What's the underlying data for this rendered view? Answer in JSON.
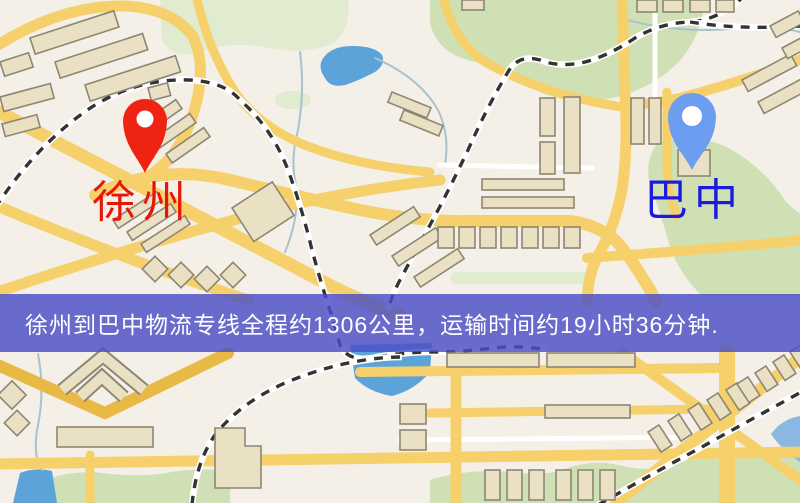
{
  "banner": {
    "text": "徐州到巴中物流专线全程约1306公里，运输时间约19小时36分钟.",
    "background_color": "rgba(74,78,198,0.82)",
    "text_color": "#ffffff",
    "route": {
      "origin": "徐州",
      "destination": "巴中",
      "distance_km": 1306,
      "duration_hours": 19,
      "duration_minutes": 36
    }
  },
  "markers": {
    "origin": {
      "label": "徐州",
      "pin_color": "#ee2312",
      "label_color": "#e71708"
    },
    "destination": {
      "label": "巴中",
      "pin_color": "#6d9df1",
      "label_color": "#1b1bdf"
    }
  },
  "map": {
    "type": "street-map",
    "palette": {
      "base": "#f4efe7",
      "road_yellow": "#f5d06b",
      "road_yellow_dark": "#e9b945",
      "road_white": "#ffffff",
      "building_fill": "#eae1c4",
      "building_outline": "#8d8672",
      "park_green": "#cfe0b4",
      "park_green_light": "#e0ebd0",
      "water_blue": "#5ba3d8",
      "water_blue_light": "#8ab8e2",
      "stream": "#a9c2cf",
      "railway": "#333333"
    }
  }
}
